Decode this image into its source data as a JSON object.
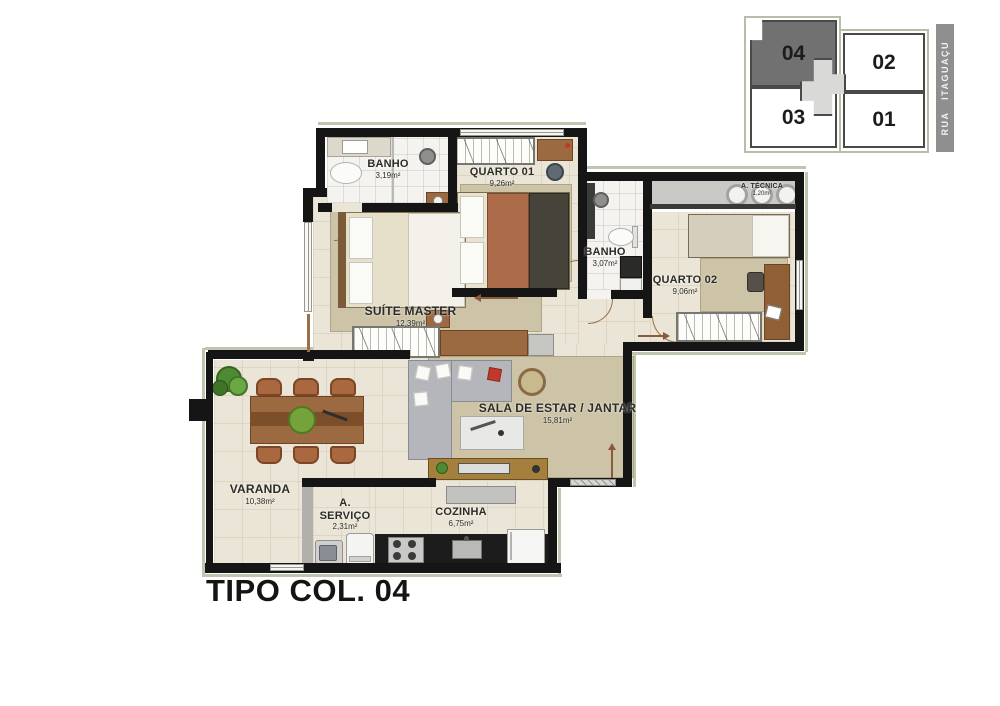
{
  "title": "TIPO COL. 04",
  "keyplan": {
    "street": "RUA ITAGUAÇU",
    "units": [
      {
        "label": "04",
        "highlighted": true
      },
      {
        "label": "02",
        "highlighted": false
      },
      {
        "label": "03",
        "highlighted": false
      },
      {
        "label": "01",
        "highlighted": false
      }
    ]
  },
  "rooms": [
    {
      "name": "BANHO",
      "area": "3,19m²"
    },
    {
      "name": "QUARTO 01",
      "area": "9,26m²"
    },
    {
      "name": "BANHO",
      "area": "3,07m²"
    },
    {
      "name": "A. TÉCNICA",
      "area": "1,20m²"
    },
    {
      "name": "QUARTO 02",
      "area": "9,06m²"
    },
    {
      "name": "SUÍTE MASTER",
      "area": "12,39m²"
    },
    {
      "name": "SALA DE ESTAR / JANTAR",
      "area": "15,81m²"
    },
    {
      "name": "VARANDA",
      "area": "10,38m²"
    },
    {
      "name": "A. SERVIÇO",
      "area": "2,31m²"
    },
    {
      "name": "COZINHA",
      "area": "6,75m²"
    }
  ],
  "colors": {
    "wall": "#151515",
    "floor": "#eae5d6",
    "bath_floor": "#f4f3ef",
    "rug": "#cdc4a8",
    "wood": "#9b6a41",
    "keyplan_highlight": "#717171",
    "keyplan_outline": "#b5bfa7",
    "street_bar": "#8f8f8f",
    "door_arc": "#9a7048"
  }
}
